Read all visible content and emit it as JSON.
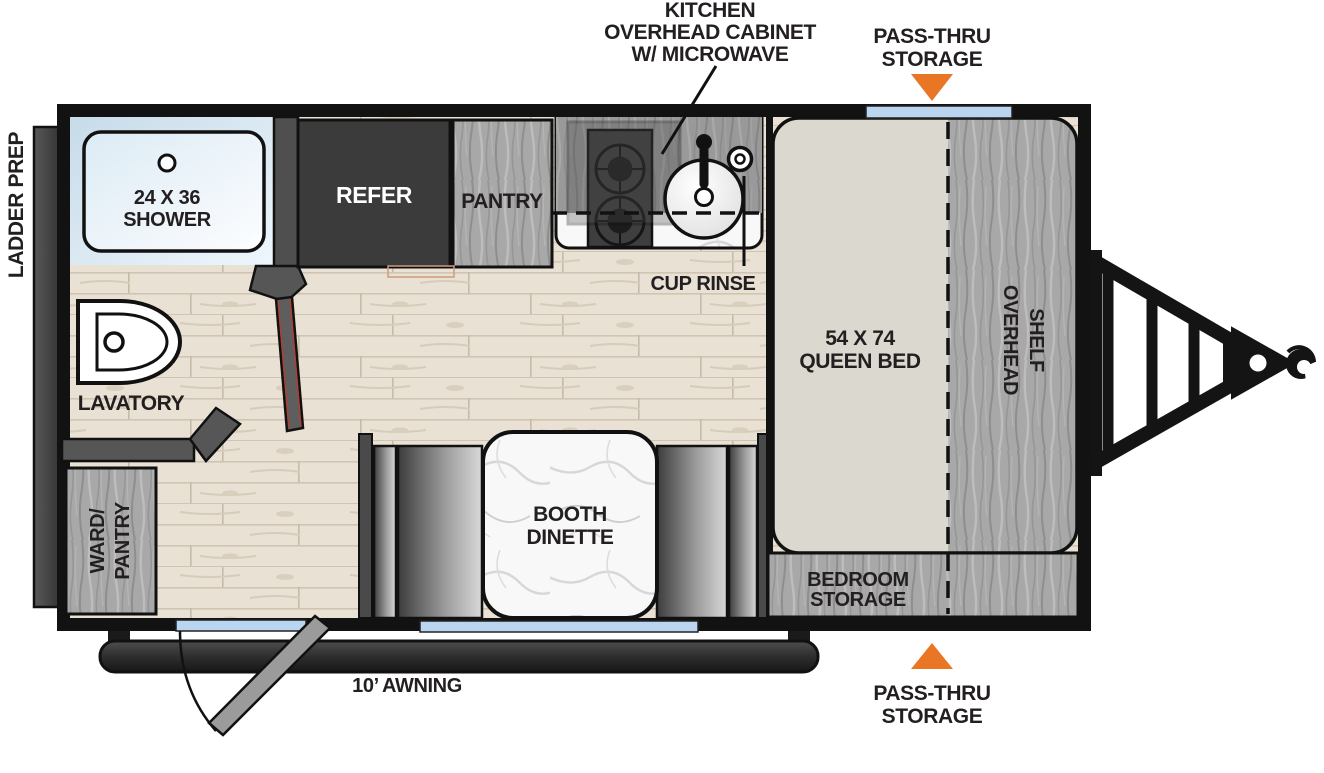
{
  "plan": {
    "type": "travel-trailer-floorplan",
    "colors": {
      "wall_black": "#121212",
      "accent_orange": "#E97625",
      "window_blue": "#B9D5EF",
      "floor_wood": "#E7E0D3",
      "cabinet_gray_wood": "#A7A7A7",
      "refer_dark": "#3B3B3B",
      "mattress_beige": "#DBD8CF",
      "label_ink": "#231F20"
    },
    "callouts": {
      "kitchen_cabinet": {
        "line1": "KITCHEN",
        "line2": "OVERHEAD CABINET",
        "line3": "W/ MICROWAVE"
      },
      "pass_thru_top": {
        "line1": "PASS-THRU",
        "line2": "STORAGE"
      },
      "pass_thru_bottom": {
        "line1": "PASS-THRU",
        "line2": "STORAGE"
      },
      "ladder_prep": "LADDER PREP",
      "cup_rinse": "CUP RINSE",
      "awning": "10’ AWNING"
    },
    "rooms": {
      "shower": {
        "line1": "24 X 36",
        "line2": "SHOWER"
      },
      "refer": "REFER",
      "pantry": "PANTRY",
      "queen_bed": {
        "line1": "54 X 74",
        "line2": "QUEEN BED"
      },
      "overhead_shelf": {
        "line1": "OVERHEAD",
        "line2": "SHELF"
      },
      "lavatory": "LAVATORY",
      "ward_pantry": {
        "line1": "WARD/",
        "line2": "PANTRY"
      },
      "booth_dinette": {
        "line1": "BOOTH",
        "line2": "DINETTE"
      },
      "bedroom_storage": {
        "line1": "BEDROOM",
        "line2": "STORAGE"
      }
    }
  }
}
